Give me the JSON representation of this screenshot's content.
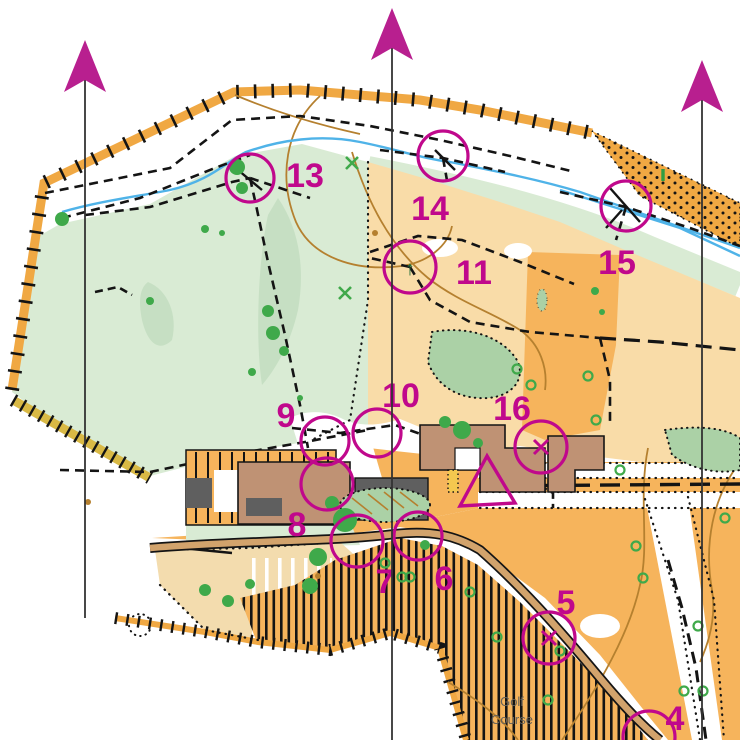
{
  "map": {
    "kind": "orienteering course map",
    "area_label": {
      "lines": [
        "Golf",
        "Course"
      ],
      "x": 512,
      "y": 706,
      "line_height": 18,
      "color": "#66625a",
      "font_size": 13
    },
    "course": {
      "color": "#c0088c",
      "number_font_size": 34,
      "start_triangle": {
        "points": "487,456 460,506 515,503"
      },
      "controls": [
        {
          "number": "4",
          "x": 649,
          "y": 737,
          "r": 26,
          "label_x": 675,
          "label_y": 730,
          "symbol": ""
        },
        {
          "number": "5",
          "x": 549,
          "y": 638,
          "r": 26,
          "label_x": 566,
          "label_y": 614,
          "symbol": "x"
        },
        {
          "number": "6",
          "x": 418,
          "y": 536,
          "r": 24,
          "label_x": 444,
          "label_y": 590,
          "symbol": ""
        },
        {
          "number": "7",
          "x": 357,
          "y": 541,
          "r": 26,
          "label_x": 385,
          "label_y": 593,
          "symbol": ""
        },
        {
          "number": "8",
          "x": 327,
          "y": 484,
          "r": 26,
          "label_x": 297,
          "label_y": 536,
          "symbol": ""
        },
        {
          "number": "9",
          "x": 325,
          "y": 441,
          "r": 24,
          "label_x": 286,
          "label_y": 427,
          "symbol": ""
        },
        {
          "number": "10",
          "x": 377,
          "y": 433,
          "r": 24,
          "label_x": 401,
          "label_y": 407,
          "symbol": ""
        },
        {
          "number": "11",
          "x": 410,
          "y": 267,
          "r": 26,
          "label_x": 474,
          "label_y": 284,
          "symbol": "tree"
        },
        {
          "number": "13",
          "x": 250,
          "y": 178,
          "r": 24,
          "label_x": 305,
          "label_y": 187,
          "symbol": ""
        },
        {
          "number": "14",
          "x": 443,
          "y": 156,
          "r": 25,
          "label_x": 430,
          "label_y": 220,
          "symbol": ""
        },
        {
          "number": "15",
          "x": 626,
          "y": 206,
          "r": 25,
          "label_x": 617,
          "label_y": 274,
          "symbol": ""
        },
        {
          "number": "16",
          "x": 541,
          "y": 447,
          "r": 26,
          "label_x": 512,
          "label_y": 420,
          "symbol": "x"
        }
      ]
    },
    "north_lines": {
      "arrow_color": "#b81f8f",
      "line_color": "#333333",
      "items": [
        {
          "x": 85,
          "tip_y": 40,
          "line_bottom": 618
        },
        {
          "x": 392,
          "tip_y": 8,
          "line_bottom": 740
        },
        {
          "x": 702,
          "tip_y": 60,
          "line_bottom": 740
        }
      ]
    },
    "palette": {
      "magenta": "#c0088c",
      "green_open_forest": "#d9ebd4",
      "green_patch": "#c6dfc3",
      "veg_medium": "#abd1a6",
      "tree_green": "#3fa94a",
      "orange_open": "#f6b45c",
      "orange_rough": "#f9dca8",
      "band_orange": "#f0a843",
      "olive_band": "#d9b945",
      "road_tan": "#d2a36c",
      "building_brown": "#bf9274",
      "building_gray": "#5f5f5f",
      "water_blue": "#4fb3e8",
      "contour_brown": "#b5802f"
    }
  }
}
